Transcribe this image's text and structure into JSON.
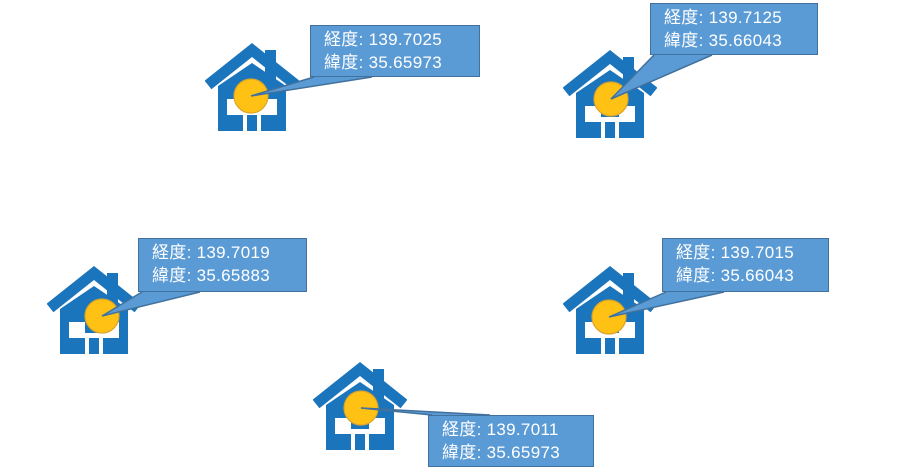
{
  "canvas": {
    "width": 904,
    "height": 471,
    "background": "#ffffff"
  },
  "labels": {
    "longitude_label": "経度",
    "latitude_label": "緯度",
    "separator": ": "
  },
  "colors": {
    "house_blue": "#1B75BC",
    "circle_fill": "#FFC114",
    "circle_stroke": "#DCA428",
    "callout_fill": "#5B9BD5",
    "callout_border": "#41719C",
    "callout_text": "#FFFFFF"
  },
  "markers": [
    {
      "longitude": "139.7025",
      "latitude": "35.65973",
      "house": {
        "x": 205,
        "y": 41
      },
      "circle": {
        "cx": 251,
        "cy": 96,
        "r": 17
      },
      "callout": {
        "x": 310,
        "y": 25,
        "w": 170,
        "h": 52,
        "tail_side": "bottom"
      }
    },
    {
      "longitude": "139.7125",
      "latitude": "35.66043",
      "house": {
        "x": 563,
        "y": 48
      },
      "circle": {
        "cx": 611,
        "cy": 99,
        "r": 17
      },
      "callout": {
        "x": 650,
        "y": 3,
        "w": 168,
        "h": 52,
        "tail_side": "bottom"
      }
    },
    {
      "longitude": "139.7019",
      "latitude": "35.65883",
      "house": {
        "x": 47,
        "y": 264
      },
      "circle": {
        "cx": 102,
        "cy": 316,
        "r": 17
      },
      "callout": {
        "x": 138,
        "y": 238,
        "w": 169,
        "h": 54,
        "tail_side": "bottom"
      }
    },
    {
      "longitude": "139.7015",
      "latitude": "35.66043",
      "house": {
        "x": 563,
        "y": 264
      },
      "circle": {
        "cx": 609,
        "cy": 317,
        "r": 17
      },
      "callout": {
        "x": 662,
        "y": 238,
        "w": 167,
        "h": 54,
        "tail_side": "bottom"
      }
    },
    {
      "longitude": "139.7011",
      "latitude": "35.65973",
      "house": {
        "x": 313,
        "y": 360
      },
      "circle": {
        "cx": 361,
        "cy": 408,
        "r": 17
      },
      "callout": {
        "x": 428,
        "y": 415,
        "w": 166,
        "h": 52,
        "tail_side": "top"
      }
    }
  ]
}
